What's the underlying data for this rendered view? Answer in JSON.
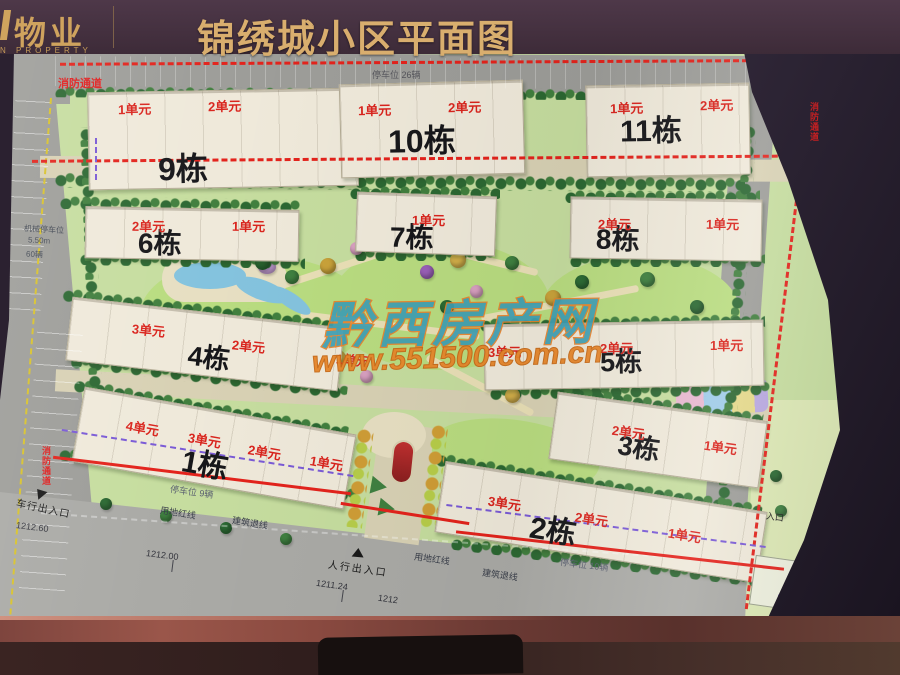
{
  "header": {
    "logo_cn": "物业",
    "logo_en": "N PROPERTY",
    "title": "锦绣城小区平面图"
  },
  "watermark": {
    "site_name": "黔西房产网",
    "site_url": "www.551500.com.cn"
  },
  "buildings": [
    {
      "name": "9栋",
      "units": [
        "1单元",
        "2单元"
      ]
    },
    {
      "name": "10栋",
      "units": [
        "1单元",
        "2单元"
      ]
    },
    {
      "name": "11栋",
      "units": [
        "1单元",
        "2单元"
      ]
    },
    {
      "name": "6栋",
      "units": [
        "2单元",
        "1单元"
      ]
    },
    {
      "name": "7栋",
      "units": [
        "1单元"
      ]
    },
    {
      "name": "8栋",
      "units": [
        "2单元",
        "1单元"
      ]
    },
    {
      "name": "4栋",
      "units": [
        "3单元",
        "2单元",
        "1单元"
      ]
    },
    {
      "name": "5栋",
      "units": [
        "3单元",
        "2单元",
        "1单元"
      ]
    },
    {
      "name": "3栋",
      "units": [
        "2单元",
        "1单元"
      ]
    },
    {
      "name": "1栋",
      "units": [
        "4单元",
        "3单元",
        "2单元",
        "1单元"
      ]
    },
    {
      "name": "2栋",
      "units": [
        "3单元",
        "2单元",
        "1单元"
      ]
    }
  ],
  "labels": {
    "fire_lane": "消防通道",
    "parking_top": "停车位 26辆",
    "parking_b1": "停车位 9辆",
    "parking_b2": "停车位 10辆",
    "mech_parking_1": "机械停车位",
    "mech_parking_2": "5.50m",
    "mech_parking_3": "60辆",
    "red_line": "用地红线",
    "setback_line": "建筑退线",
    "ped_entrance": "人行出入口",
    "car_entrance": "车行出入口",
    "entrance": "入口",
    "elev_a": "1212.60",
    "elev_b": "1212.00",
    "elev_c": "1211.24",
    "elev_d": "1212",
    "plot_g": "G"
  },
  "colors": {
    "header_bg": "#453140",
    "title_gold": "#d9ae6e",
    "unit_red": "#d9251d",
    "fire_lane_red": "#e3231c",
    "water_blue": "#84c3de"
  }
}
